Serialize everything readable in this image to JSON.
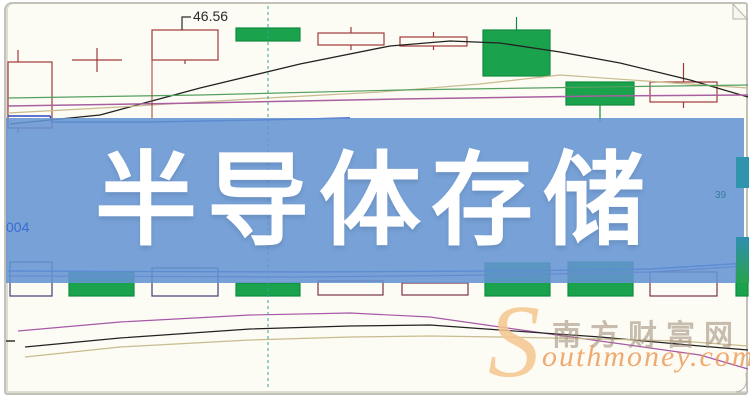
{
  "banner": {
    "text": "半导体存储"
  },
  "labels": {
    "left_axis": "004",
    "right_axis": "39"
  },
  "watermark": {
    "initial": "S",
    "cn": "南方财富网",
    "en": "outhmoney.com"
  },
  "colors": {
    "banner_bg": "rgba(100,148,210,0.87)",
    "banner_text": "#ffffff",
    "page_bg": "#fcfcf4",
    "page_border": "#c2c2b8",
    "candle_green": "#1aa24d",
    "candle_red_outline": "#a03a3a",
    "watermark_orange": "#f5c78f"
  },
  "chart_data": {
    "type": "candlestick",
    "units": "px",
    "axes_visible": false,
    "annotations": [
      {
        "name": "price-annotation",
        "text": "46.56",
        "x": 193,
        "y": 21,
        "leader": [
          [
            191,
            17
          ],
          [
            182,
            17
          ],
          [
            182,
            30
          ]
        ],
        "color": "#2a2a2a"
      }
    ],
    "candle_styles": {
      "green": {
        "fill": "#1aa24d",
        "stroke": "#128a40"
      },
      "hollow_red": {
        "fill": "none",
        "stroke": "#a03a3a"
      },
      "hollow_navy": {
        "fill": "none",
        "stroke": "#3f3f72"
      },
      "hollow_red2": {
        "fill": "none",
        "stroke": "#7a3448"
      },
      "doji": {
        "fill": "none",
        "stroke": "#a03a3a"
      }
    },
    "top_candles": [
      {
        "x": 8,
        "w": 44,
        "top": 62,
        "h": 66,
        "kind": "hollow_red",
        "wx": 18,
        "wt": 50,
        "wb": 133
      },
      {
        "x": 72,
        "w": 50,
        "top": 60,
        "h": 0,
        "kind": "doji",
        "wt": 48,
        "wb": 72
      },
      {
        "x": 152,
        "w": 66,
        "top": 30,
        "h": 30,
        "kind": "hollow_red",
        "wb": 64
      },
      {
        "x": 236,
        "w": 64,
        "top": 28,
        "h": 13,
        "kind": "green"
      },
      {
        "x": 318,
        "w": 66,
        "top": 33,
        "h": 12,
        "kind": "hollow_red",
        "wt": 27,
        "wb": 50
      },
      {
        "x": 400,
        "w": 67,
        "top": 37,
        "h": 9,
        "kind": "hollow_red",
        "wt": 32,
        "wb": 50
      },
      {
        "x": 483,
        "w": 67,
        "top": 30,
        "h": 46,
        "kind": "green",
        "wt": 17
      },
      {
        "x": 566,
        "w": 68,
        "top": 82,
        "h": 23,
        "kind": "green",
        "wb": 122
      },
      {
        "x": 650,
        "w": 67,
        "top": 82,
        "h": 20,
        "kind": "hollow_red",
        "wt": 63,
        "wb": 108
      }
    ],
    "bottom_candles": [
      {
        "x": 10,
        "w": 42,
        "top": 262,
        "h": 34,
        "kind": "hollow_navy"
      },
      {
        "x": 69,
        "w": 65,
        "top": 272,
        "h": 24,
        "kind": "green"
      },
      {
        "x": 152,
        "w": 66,
        "top": 268,
        "h": 28,
        "kind": "hollow_navy"
      },
      {
        "x": 236,
        "w": 64,
        "top": 283,
        "h": 13,
        "kind": "green"
      },
      {
        "x": 318,
        "w": 65,
        "top": 281,
        "h": 14,
        "kind": "hollow_red2"
      },
      {
        "x": 402,
        "w": 66,
        "top": 283,
        "h": 12,
        "kind": "hollow_red2"
      },
      {
        "x": 485,
        "w": 65,
        "top": 263,
        "h": 33,
        "kind": "green"
      },
      {
        "x": 568,
        "w": 65,
        "top": 262,
        "h": 34,
        "kind": "green"
      },
      {
        "x": 650,
        "w": 67,
        "top": 272,
        "h": 24,
        "kind": "hollow_red2"
      },
      {
        "x": 736,
        "w": 12,
        "top": 264,
        "h": 32,
        "kind": "green"
      }
    ],
    "edge_bars": [
      {
        "x": 736,
        "y": 157,
        "w": 13,
        "h": 31,
        "color": "#2f95ad",
        "color2": "#2f95ad"
      },
      {
        "x": 736,
        "y": 237,
        "w": 13,
        "h": 46,
        "color": "#2f8fb0",
        "color2": "#27a24c"
      }
    ],
    "lines": [
      {
        "name": "ma-black-top",
        "color": "#222222",
        "width": 1.3,
        "points": [
          [
            10,
            124
          ],
          [
            100,
            115
          ],
          [
            200,
            88
          ],
          [
            300,
            64
          ],
          [
            390,
            46
          ],
          [
            450,
            41
          ],
          [
            500,
            43
          ],
          [
            560,
            52
          ],
          [
            620,
            63
          ],
          [
            690,
            80
          ],
          [
            748,
            97
          ]
        ]
      },
      {
        "name": "ma-tan-top",
        "color": "#c9bb8e",
        "width": 1.2,
        "points": [
          [
            8,
            113
          ],
          [
            120,
            107
          ],
          [
            250,
            99
          ],
          [
            380,
            92
          ],
          [
            480,
            84
          ],
          [
            560,
            75
          ],
          [
            660,
            82
          ],
          [
            748,
            88
          ]
        ]
      },
      {
        "name": "ma-green-top",
        "color": "#55a060",
        "width": 1.2,
        "points": [
          [
            8,
            98
          ],
          [
            200,
            95
          ],
          [
            400,
            90
          ],
          [
            600,
            87
          ],
          [
            748,
            85
          ]
        ]
      },
      {
        "name": "ma-magenta-top",
        "color": "#a860a0",
        "width": 1.5,
        "points": [
          [
            8,
            106
          ],
          [
            200,
            103
          ],
          [
            400,
            99
          ],
          [
            600,
            96
          ],
          [
            748,
            95
          ]
        ]
      },
      {
        "name": "ma-blue-top",
        "color": "#2947c4",
        "width": 1.4,
        "points": [
          [
            8,
            116
          ],
          [
            50,
            116
          ],
          [
            52,
            122
          ],
          [
            150,
            122
          ],
          [
            260,
            120
          ],
          [
            350,
            118
          ]
        ]
      },
      {
        "name": "red-vertical-tick",
        "color": "#a03a3a",
        "width": 1,
        "points": [
          [
            152,
            60
          ],
          [
            152,
            118
          ]
        ]
      },
      {
        "name": "row2-blue-line",
        "color": "#3a55d0",
        "width": 1.4,
        "points": [
          [
            8,
            271
          ],
          [
            300,
            272
          ],
          [
            500,
            271
          ],
          [
            650,
            269
          ],
          [
            748,
            263
          ]
        ]
      },
      {
        "name": "row2-purple-line",
        "color": "#7050c0",
        "width": 1.3,
        "points": [
          [
            8,
            276
          ],
          [
            300,
            277
          ],
          [
            500,
            275
          ],
          [
            650,
            272
          ],
          [
            748,
            266
          ]
        ]
      },
      {
        "name": "sub-magenta-line",
        "color": "#a858a8",
        "width": 1.2,
        "points": [
          [
            18,
            331
          ],
          [
            120,
            322
          ],
          [
            250,
            315
          ],
          [
            350,
            313
          ],
          [
            430,
            317
          ],
          [
            500,
            327
          ],
          [
            600,
            341
          ],
          [
            700,
            355
          ],
          [
            748,
            369
          ]
        ]
      },
      {
        "name": "sub-black-line",
        "color": "#222222",
        "width": 1.2,
        "points": [
          [
            25,
            347
          ],
          [
            120,
            338
          ],
          [
            250,
            329
          ],
          [
            350,
            326
          ],
          [
            430,
            325
          ],
          [
            500,
            330
          ],
          [
            600,
            337
          ],
          [
            700,
            346
          ],
          [
            748,
            350
          ]
        ]
      },
      {
        "name": "sub-tan-line",
        "color": "#c9bb8e",
        "width": 1.2,
        "points": [
          [
            25,
            357
          ],
          [
            120,
            347
          ],
          [
            250,
            340
          ],
          [
            350,
            337
          ],
          [
            430,
            336
          ],
          [
            500,
            337
          ],
          [
            600,
            339
          ],
          [
            680,
            341
          ],
          [
            748,
            346
          ]
        ]
      },
      {
        "name": "time-divider",
        "color": "#3aa0a0",
        "width": 1,
        "dash": "3,3",
        "points": [
          [
            268,
            6
          ],
          [
            268,
            390
          ]
        ]
      },
      {
        "name": "bottom-left-tick",
        "color": "#222222",
        "width": 1.4,
        "points": [
          [
            6,
            341
          ],
          [
            15,
            341
          ]
        ]
      }
    ]
  }
}
